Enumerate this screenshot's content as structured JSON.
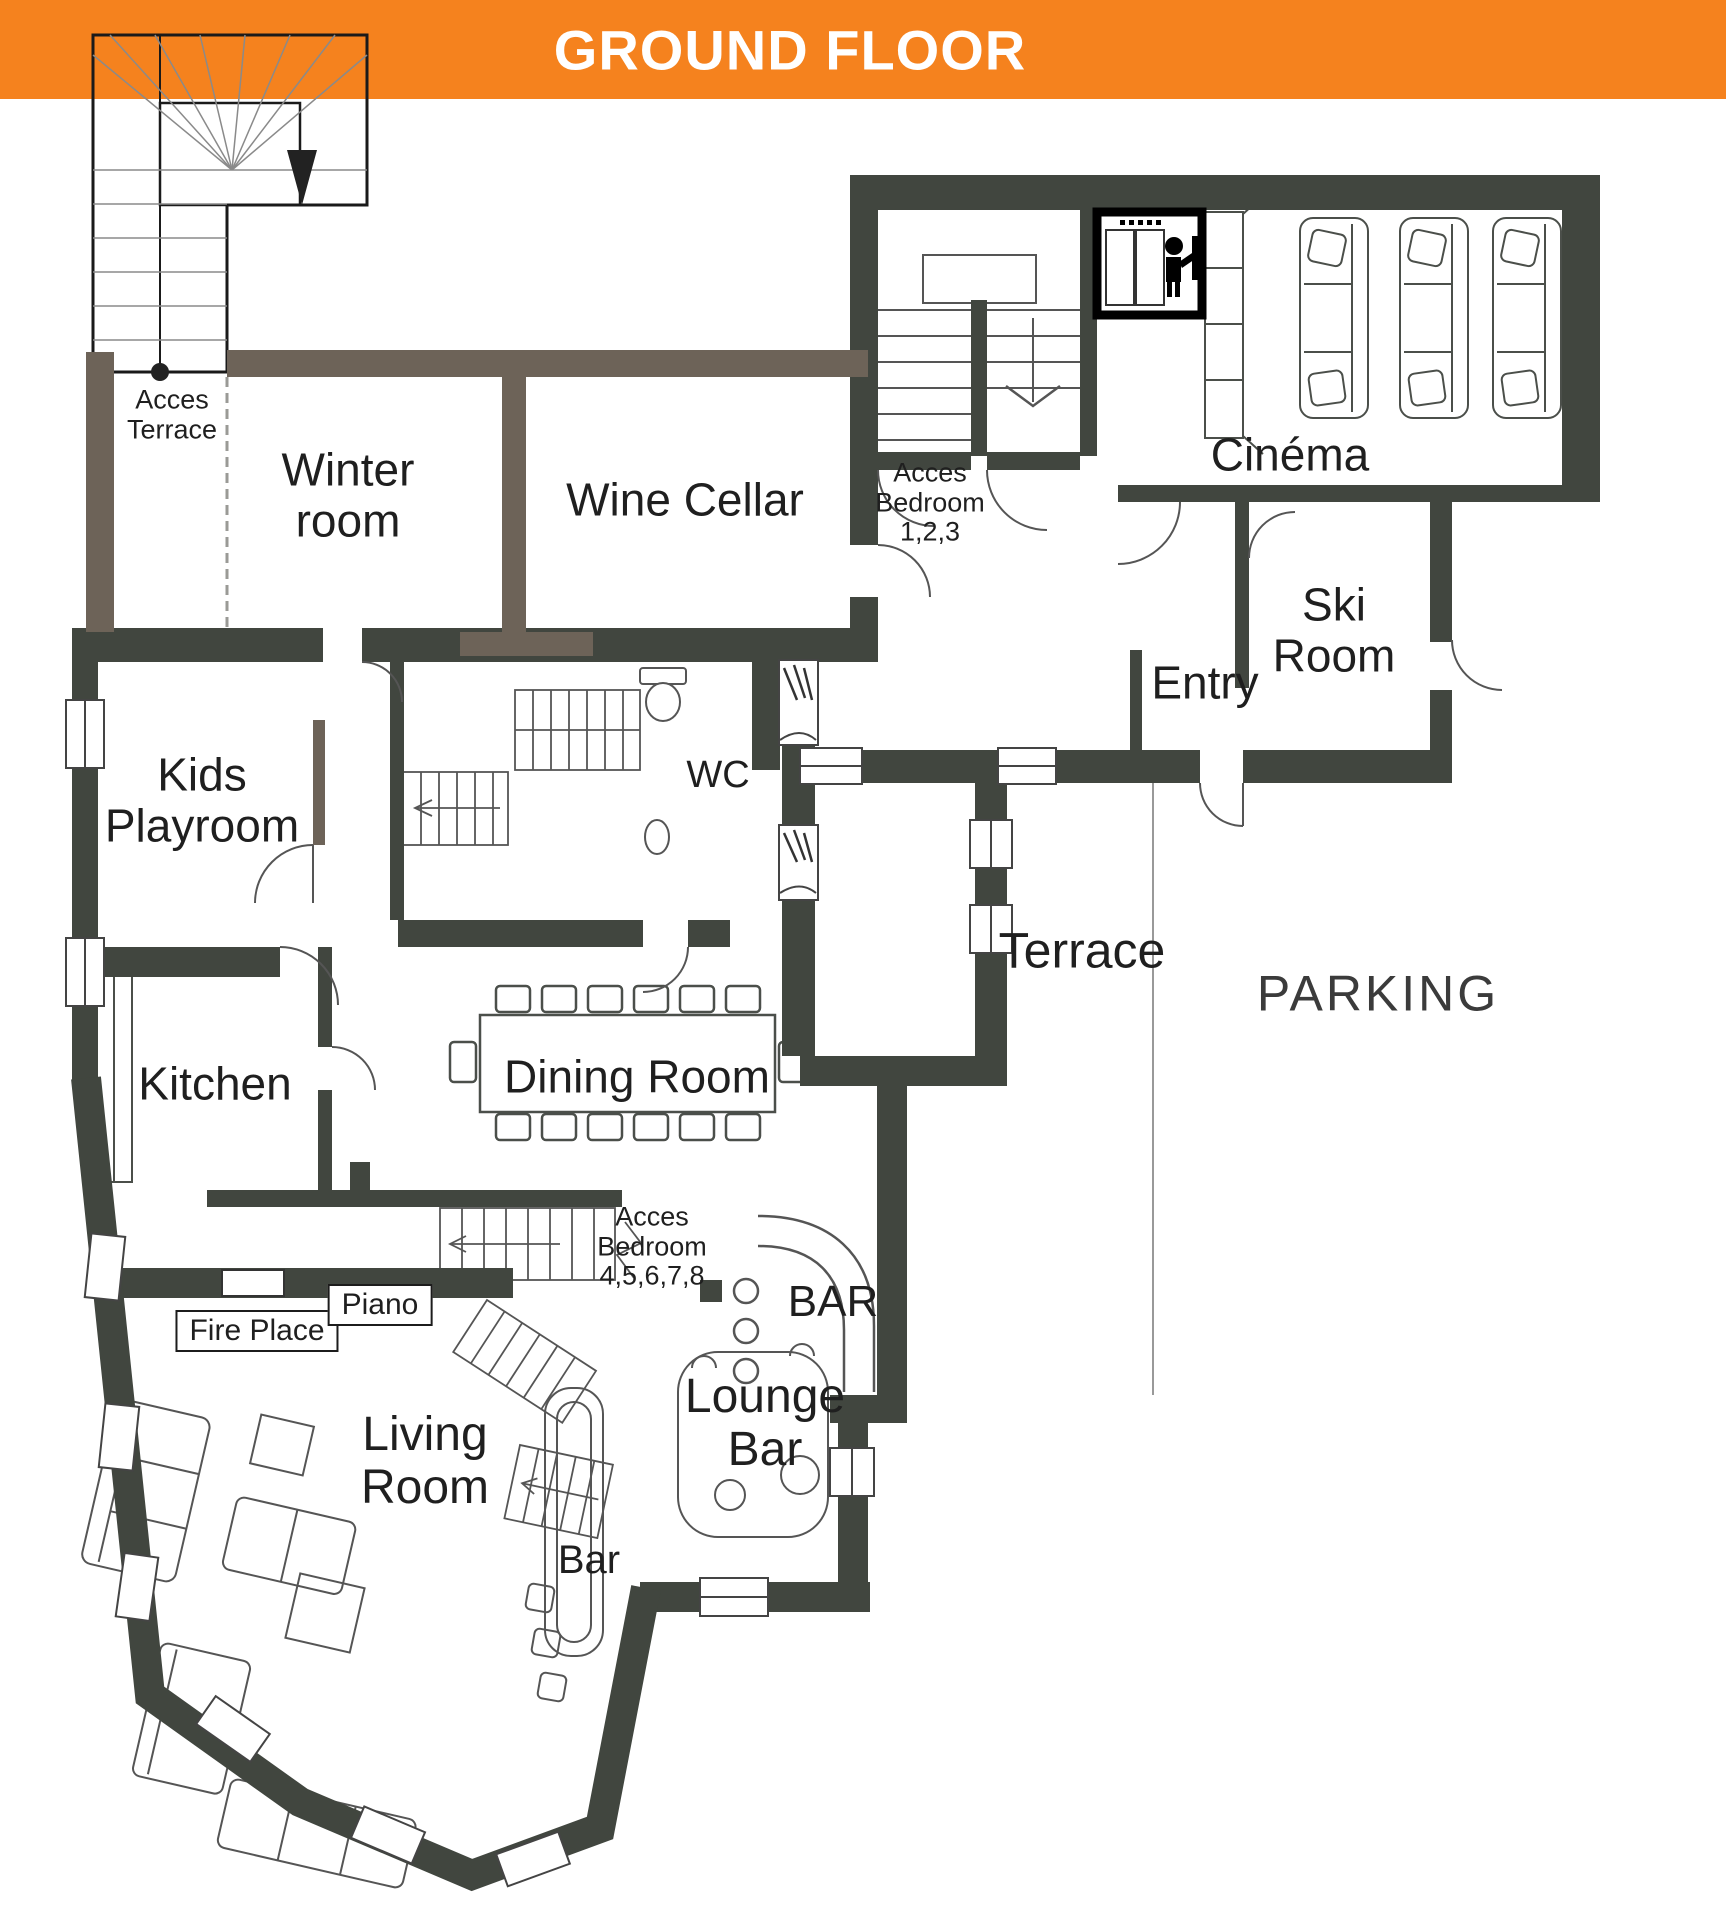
{
  "banner": {
    "title": "GROUND FLOOR",
    "background": "#F5821E",
    "text_color": "#FFFFFF"
  },
  "palette": {
    "wall_dark": "#41463F",
    "wall_brown": "#6D6358",
    "drawing_line": "#4B4F4A",
    "label_text": "#1F1F1F",
    "parking_text": "#3B3B3B"
  },
  "rooms": {
    "winter_room": "Winter room",
    "wine_cellar": "Wine Cellar",
    "cinema": "Cinéma",
    "ski_room": "Ski Room",
    "entry": "Entry",
    "kids_playroom": "Kids Playroom",
    "wc": "WC",
    "terrace": "Terrace",
    "parking": "PARKING",
    "kitchen": "Kitchen",
    "dining_room": "Dining Room",
    "living_room": "Living Room",
    "lounge_bar": "Lounge Bar",
    "bar": "BAR",
    "bar_small": "Bar"
  },
  "annotations": {
    "acces_terrace": "Acces Terrace",
    "acces_bedroom_123": "Acces Bedroom 1,2,3",
    "acces_bedroom_45678": "Acces Bedroom 4,5,6,7,8"
  },
  "callouts": {
    "fire_place": "Fire Place",
    "piano": "Piano"
  },
  "icons": {
    "elevator_icon": "person pressing elevator call button",
    "stairs_down_arrow_icon": "▼"
  }
}
